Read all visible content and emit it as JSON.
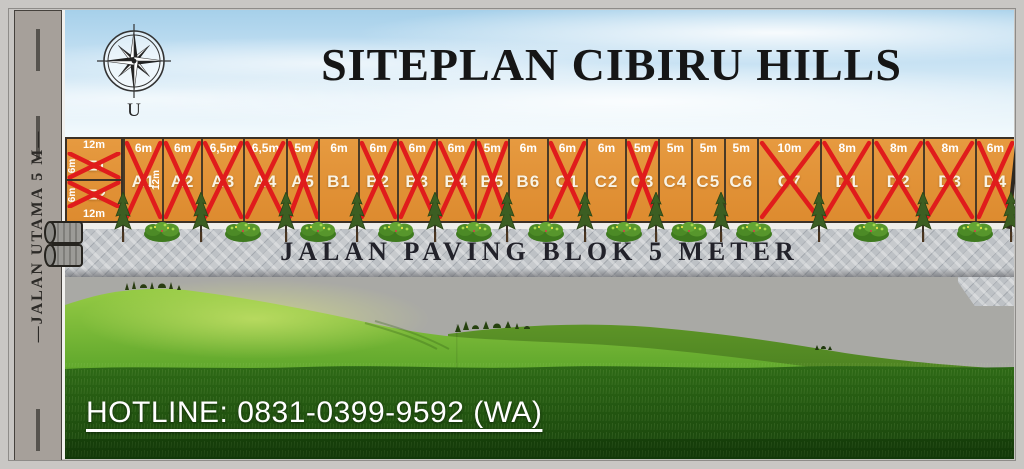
{
  "poster": {
    "title": "SITEPLAN CIBIRU HILLS",
    "compass_north_label": "U",
    "hotline_label": "HOTLINE: 0831-0399-9592 (WA)"
  },
  "roads": {
    "main_road_label": "—JALAN UTAMA 5 M—",
    "paving_road_label": "JALAN PAVING BLOK 5 METER"
  },
  "corner_block": {
    "top_width_label": "12m",
    "bottom_width_label": "12m",
    "units": [
      {
        "name": "E1",
        "side_depth_label": "6m",
        "crossed": true
      },
      {
        "name": "E2",
        "side_depth_label": "6m",
        "crossed": true
      }
    ]
  },
  "plots": [
    {
      "name": "A1",
      "width_label": "6m",
      "width_m": 6,
      "crossed": true,
      "depth_label": "12m"
    },
    {
      "name": "A2",
      "width_label": "6m",
      "width_m": 6,
      "crossed": true
    },
    {
      "name": "A3",
      "width_label": "6,5m",
      "width_m": 6.5,
      "crossed": true
    },
    {
      "name": "A4",
      "width_label": "6,5m",
      "width_m": 6.5,
      "crossed": true
    },
    {
      "name": "A5",
      "width_label": "5m",
      "width_m": 5,
      "crossed": true
    },
    {
      "name": "B1",
      "width_label": "6m",
      "width_m": 6,
      "crossed": false
    },
    {
      "name": "B2",
      "width_label": "6m",
      "width_m": 6,
      "crossed": true
    },
    {
      "name": "B3",
      "width_label": "6m",
      "width_m": 6,
      "crossed": true
    },
    {
      "name": "B4",
      "width_label": "6m",
      "width_m": 6,
      "crossed": true
    },
    {
      "name": "B5",
      "width_label": "5m",
      "width_m": 5,
      "crossed": true
    },
    {
      "name": "B6",
      "width_label": "6m",
      "width_m": 6,
      "crossed": false
    },
    {
      "name": "C1",
      "width_label": "6m",
      "width_m": 6,
      "crossed": true
    },
    {
      "name": "C2",
      "width_label": "6m",
      "width_m": 6,
      "crossed": false
    },
    {
      "name": "C3",
      "width_label": "5m",
      "width_m": 5,
      "crossed": true
    },
    {
      "name": "C4",
      "width_label": "5m",
      "width_m": 5,
      "crossed": false
    },
    {
      "name": "C5",
      "width_label": "5m",
      "width_m": 5,
      "crossed": false
    },
    {
      "name": "C6",
      "width_label": "5m",
      "width_m": 5,
      "crossed": false
    },
    {
      "name": "C7",
      "width_label": "10m",
      "width_m": 10,
      "crossed": true
    },
    {
      "name": "D1",
      "width_label": "8m",
      "width_m": 8,
      "crossed": true
    },
    {
      "name": "D2",
      "width_label": "8m",
      "width_m": 8,
      "crossed": true
    },
    {
      "name": "D3",
      "width_label": "8m",
      "width_m": 8,
      "crossed": true
    },
    {
      "name": "D4",
      "width_label": "6m",
      "width_m": 6,
      "crossed": true
    }
  ],
  "colors": {
    "plot_orange": "#E2933A",
    "cross_red": "#E01C1C",
    "sky_blue": "#AFD4EC",
    "grass_green": "#5FA42B",
    "road_gray": "#A6A09A",
    "paving_gray": "#B9BDC2"
  }
}
